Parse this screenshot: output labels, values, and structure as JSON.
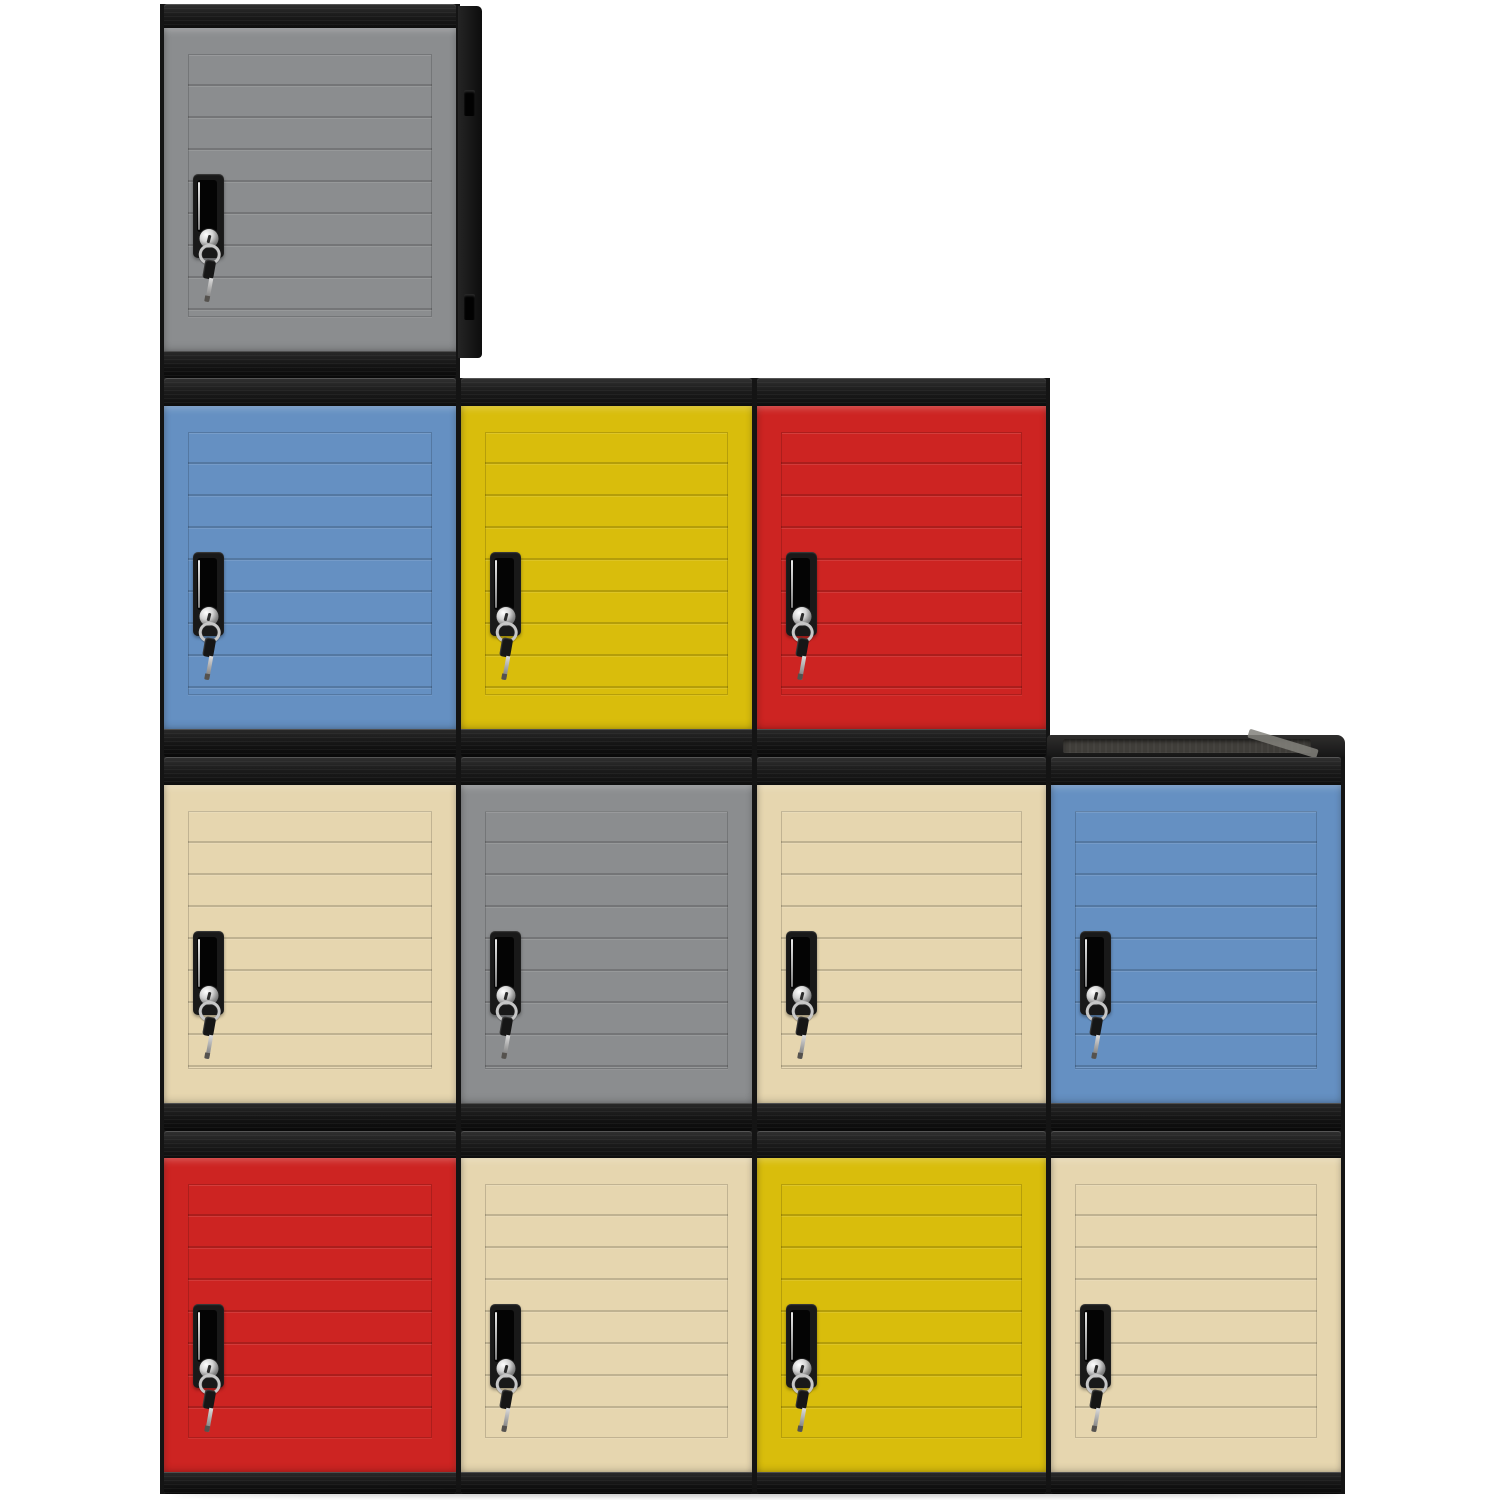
{
  "scene": {
    "type": "product-photo",
    "subject": "Twelve stackable plastic cube storage lockers with keyed doors, stacked in a staircase arrangement on a white background",
    "background_color": "#ffffff",
    "rows_by_color": [
      [
        "gray"
      ],
      [
        "blue",
        "yellow",
        "red"
      ],
      [
        "beige",
        "gray",
        "beige",
        "blue"
      ],
      [
        "red",
        "beige",
        "yellow",
        "beige"
      ]
    ]
  },
  "palette": {
    "frame_black": "#161616",
    "gray": "#8b8d8f",
    "blue": "#6590c2",
    "yellow": "#d9bd0c",
    "red": "#cd2422",
    "beige": "#e6d6af",
    "chrome": "#d2d2d2",
    "top_recess_gray": "#403e3a"
  },
  "layout": {
    "canvas": {
      "w": 1500,
      "h": 1500
    },
    "rows": [
      {
        "y": 4,
        "cap": 24,
        "door": 323,
        "base": 27
      },
      {
        "y": 378,
        "cap": 28,
        "door": 323,
        "base": 28
      },
      {
        "y": 757,
        "cap": 28,
        "door": 318,
        "base": 28
      },
      {
        "y": 1131,
        "cap": 27,
        "door": 314,
        "base": 22
      }
    ],
    "cols": [
      {
        "x": 164,
        "w": 292
      },
      {
        "x": 461,
        "w": 291
      },
      {
        "x": 757,
        "w": 289
      },
      {
        "x": 1051,
        "w": 290
      }
    ]
  },
  "lockers": [
    {
      "id": "r1c1",
      "row": 1,
      "col": 1,
      "color_name": "gray",
      "hex": "#8b8d8f",
      "side_panel": true,
      "top_surface": false
    },
    {
      "id": "r2c1",
      "row": 2,
      "col": 1,
      "color_name": "blue",
      "hex": "#6590c2",
      "side_panel": false,
      "top_surface": false
    },
    {
      "id": "r2c2",
      "row": 2,
      "col": 2,
      "color_name": "yellow",
      "hex": "#d9bd0c",
      "side_panel": false,
      "top_surface": false
    },
    {
      "id": "r2c3",
      "row": 2,
      "col": 3,
      "color_name": "red",
      "hex": "#cd2422",
      "side_panel": false,
      "top_surface": false
    },
    {
      "id": "r3c1",
      "row": 3,
      "col": 1,
      "color_name": "beige",
      "hex": "#e6d6af",
      "side_panel": false,
      "top_surface": false
    },
    {
      "id": "r3c2",
      "row": 3,
      "col": 2,
      "color_name": "gray",
      "hex": "#8b8d8f",
      "side_panel": false,
      "top_surface": false
    },
    {
      "id": "r3c3",
      "row": 3,
      "col": 3,
      "color_name": "beige",
      "hex": "#e6d6af",
      "side_panel": false,
      "top_surface": false
    },
    {
      "id": "r3c4",
      "row": 3,
      "col": 4,
      "color_name": "blue",
      "hex": "#6590c2",
      "side_panel": false,
      "top_surface": true
    },
    {
      "id": "r4c1",
      "row": 4,
      "col": 1,
      "color_name": "red",
      "hex": "#cd2422",
      "side_panel": false,
      "top_surface": false
    },
    {
      "id": "r4c2",
      "row": 4,
      "col": 2,
      "color_name": "beige",
      "hex": "#e6d6af",
      "side_panel": false,
      "top_surface": false
    },
    {
      "id": "r4c3",
      "row": 4,
      "col": 3,
      "color_name": "yellow",
      "hex": "#d9bd0c",
      "side_panel": false,
      "top_surface": false
    },
    {
      "id": "r4c4",
      "row": 4,
      "col": 4,
      "color_name": "beige",
      "hex": "#e6d6af",
      "side_panel": false,
      "top_surface": false
    }
  ],
  "hardware": {
    "lock": "black recessed handle plate with chrome keyed cam lock cylinder",
    "key": "key on chrome split ring hanging from every lock, black key head with metal blade"
  }
}
